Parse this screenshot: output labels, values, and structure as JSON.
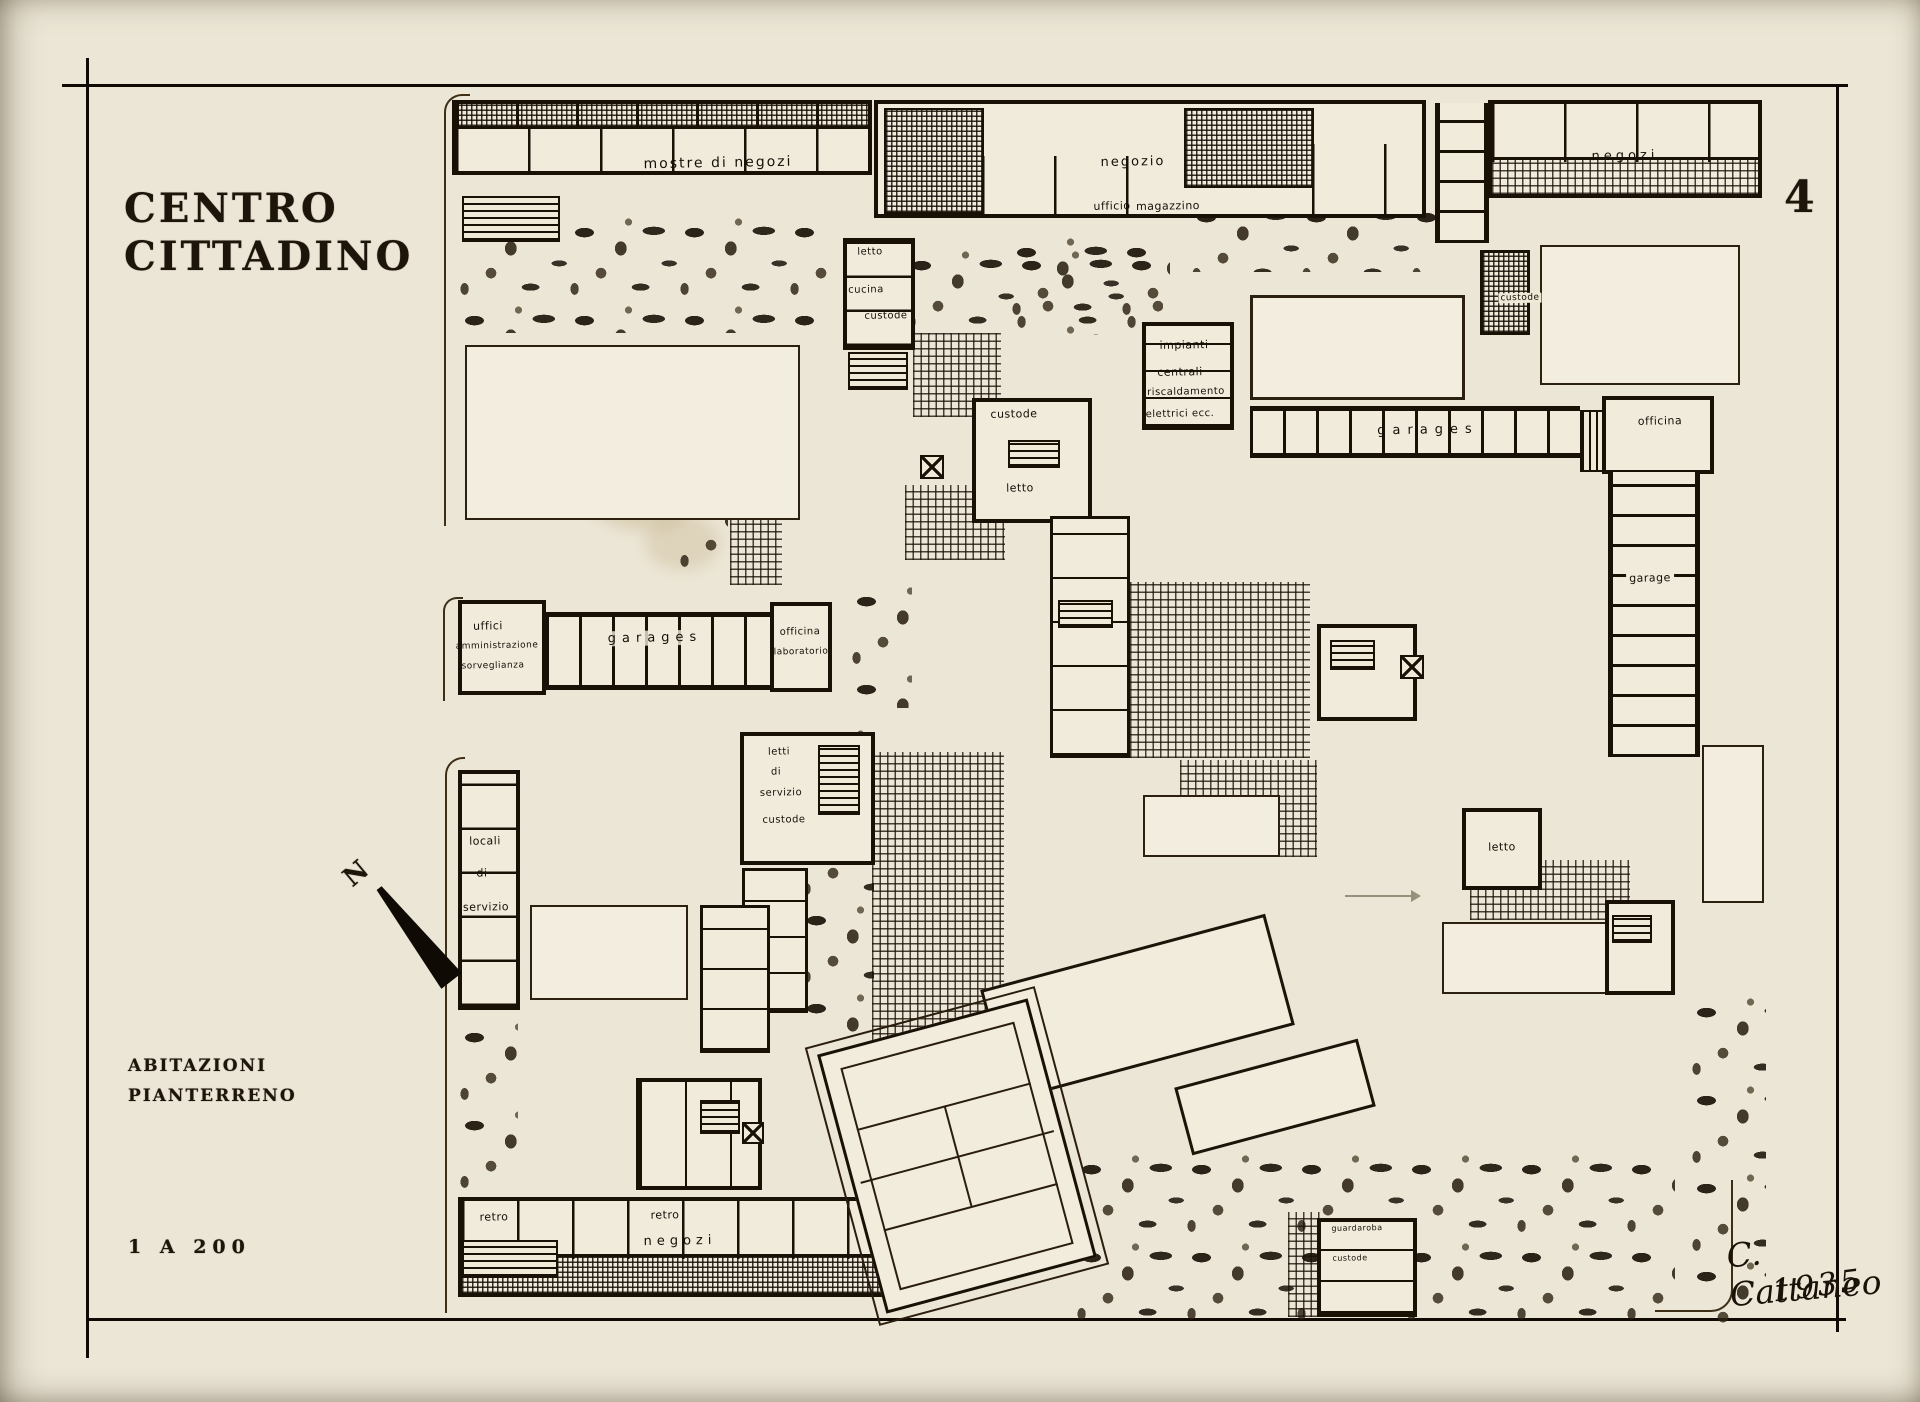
{
  "plate_number": "4",
  "title_block": {
    "line1": "CENTRO",
    "line2": "CITTADINO"
  },
  "legend": {
    "line1": "ABITAZIONI",
    "line2": "PIANTERRENO",
    "scale": "1 A 200"
  },
  "north_letter": "N",
  "signature": {
    "name": "C. Cattaneo",
    "year": "1935"
  },
  "labels": {
    "mostre_di_negozi": "mostre di negozi",
    "negozio": "negozio",
    "ufficio": "ufficio",
    "magazzino": "magazzino",
    "negozi_top": "negozi",
    "letto_nw": "letto",
    "cucina": "cucina",
    "custode_nw": "custode",
    "custode_c": "custode",
    "letto_c": "letto",
    "impianti_l1": "impianti",
    "impianti_l2": "centrali",
    "impianti_l3": "riscaldamento",
    "impianti_l4": "elettrici ecc.",
    "garages_main": "garages",
    "officina_e": "officina",
    "garage_e": "garage",
    "custode_ne": "custode",
    "uffici_l1": "uffici",
    "uffici_l2": "amministrazione",
    "uffici_l3": "sorveglianza",
    "garages_w": "garages",
    "officina_w_l1": "officina",
    "officina_w_l2": "laboratorio",
    "letti_l1": "letti",
    "letti_l2": "di",
    "letti_l3": "servizio",
    "custode_m": "custode",
    "locali_l1": "locali",
    "locali_l2": "di",
    "locali_l3": "servizio",
    "letto_se": "letto",
    "retro_w": "retro",
    "retro_c": "retro",
    "negozi_s": "negozi",
    "guardaroba": "guardaroba",
    "custode_s": "custode"
  }
}
